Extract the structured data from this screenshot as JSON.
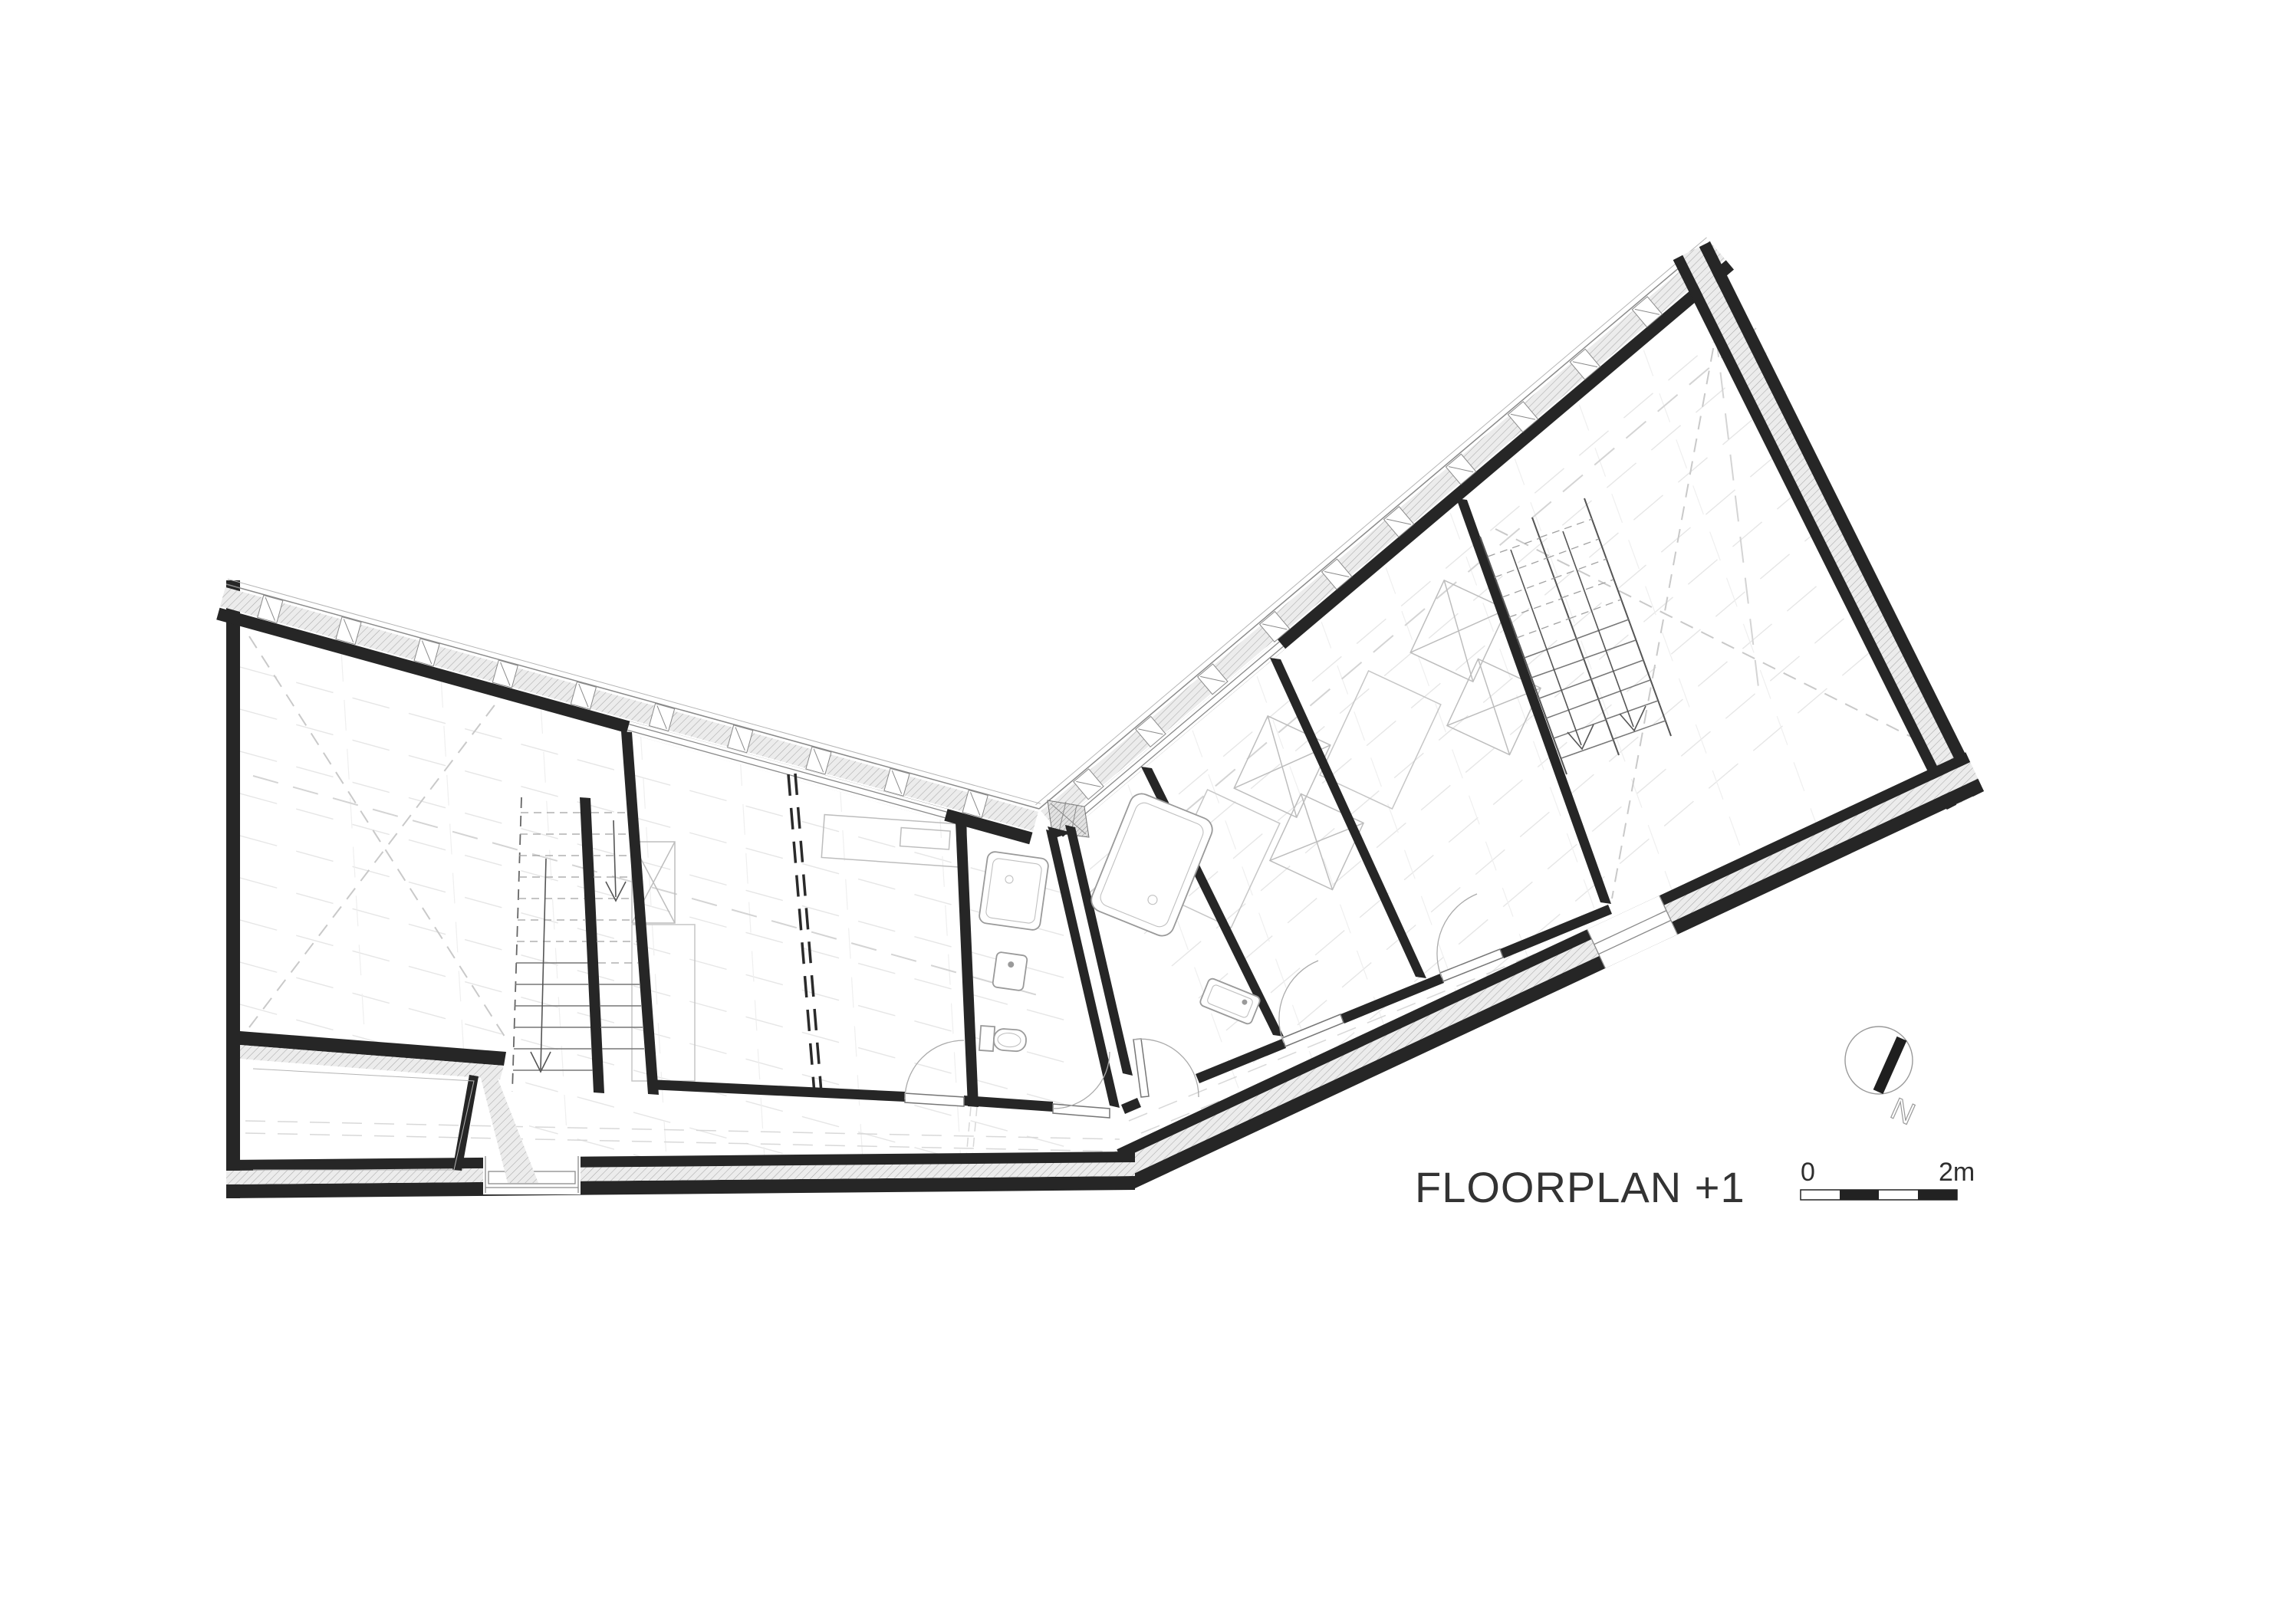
{
  "drawing": {
    "title": "FLOORPLAN +1",
    "scale_bar": {
      "start_label": "0",
      "end_label": "2m"
    },
    "north_arrow": {
      "label": "N"
    },
    "colors": {
      "background": "#ffffff",
      "wall_black": "#262626",
      "hatch_fill": "#ececec",
      "hatch_stroke": "#a9a9a9",
      "thin_line": "#8a8a8a",
      "faint_line": "#e6e6e6",
      "text": "#333333"
    }
  }
}
